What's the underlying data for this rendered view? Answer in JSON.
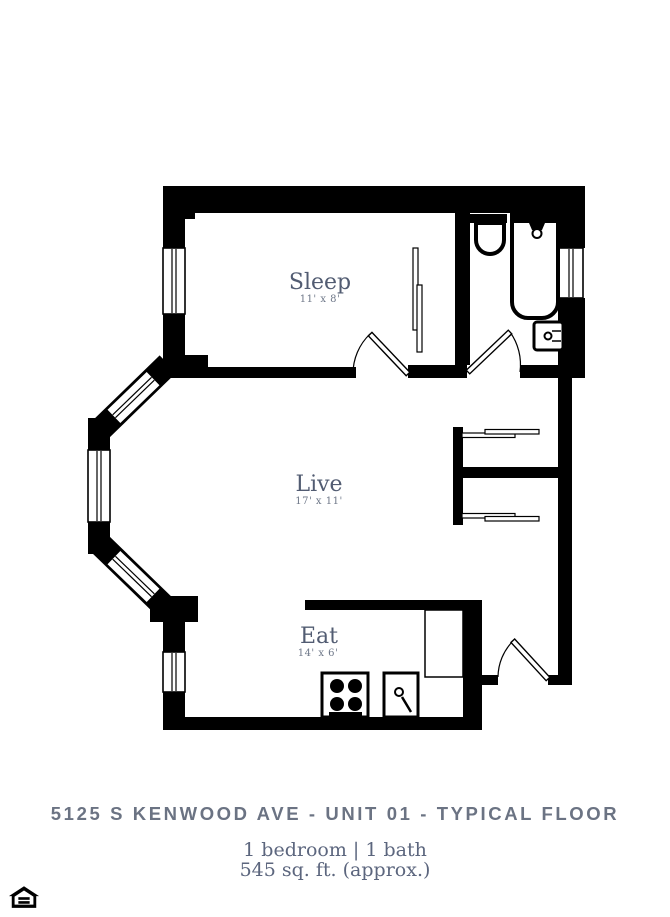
{
  "colors": {
    "wall_color": "#000000",
    "room_label": "#525c72",
    "room_dims": "#6f7889",
    "title": "#6b7383",
    "subtitle": "#5c667e",
    "background": "#ffffff"
  },
  "floorplan": {
    "rooms": [
      {
        "label": "Sleep",
        "dimensions": "11' x 8'"
      },
      {
        "label": "Live",
        "dimensions": "17' x 11'"
      },
      {
        "label": "Eat",
        "dimensions": "14' x 6'"
      }
    ],
    "fixtures": [
      "toilet",
      "bathtub",
      "shower-head",
      "bathroom-sink",
      "stove",
      "kitchen-sink",
      "refrigerator",
      "window",
      "swing-door",
      "sliding-closet-door"
    ]
  },
  "footer": {
    "title": "5125 S KENWOOD AVE - UNIT 01 - TYPICAL FLOOR",
    "details_line1": "1 bedroom | 1 bath",
    "details_line2": "545 sq. ft. (approx.)"
  },
  "icons": {
    "equal_housing_logo": "equal-housing-opportunity"
  }
}
